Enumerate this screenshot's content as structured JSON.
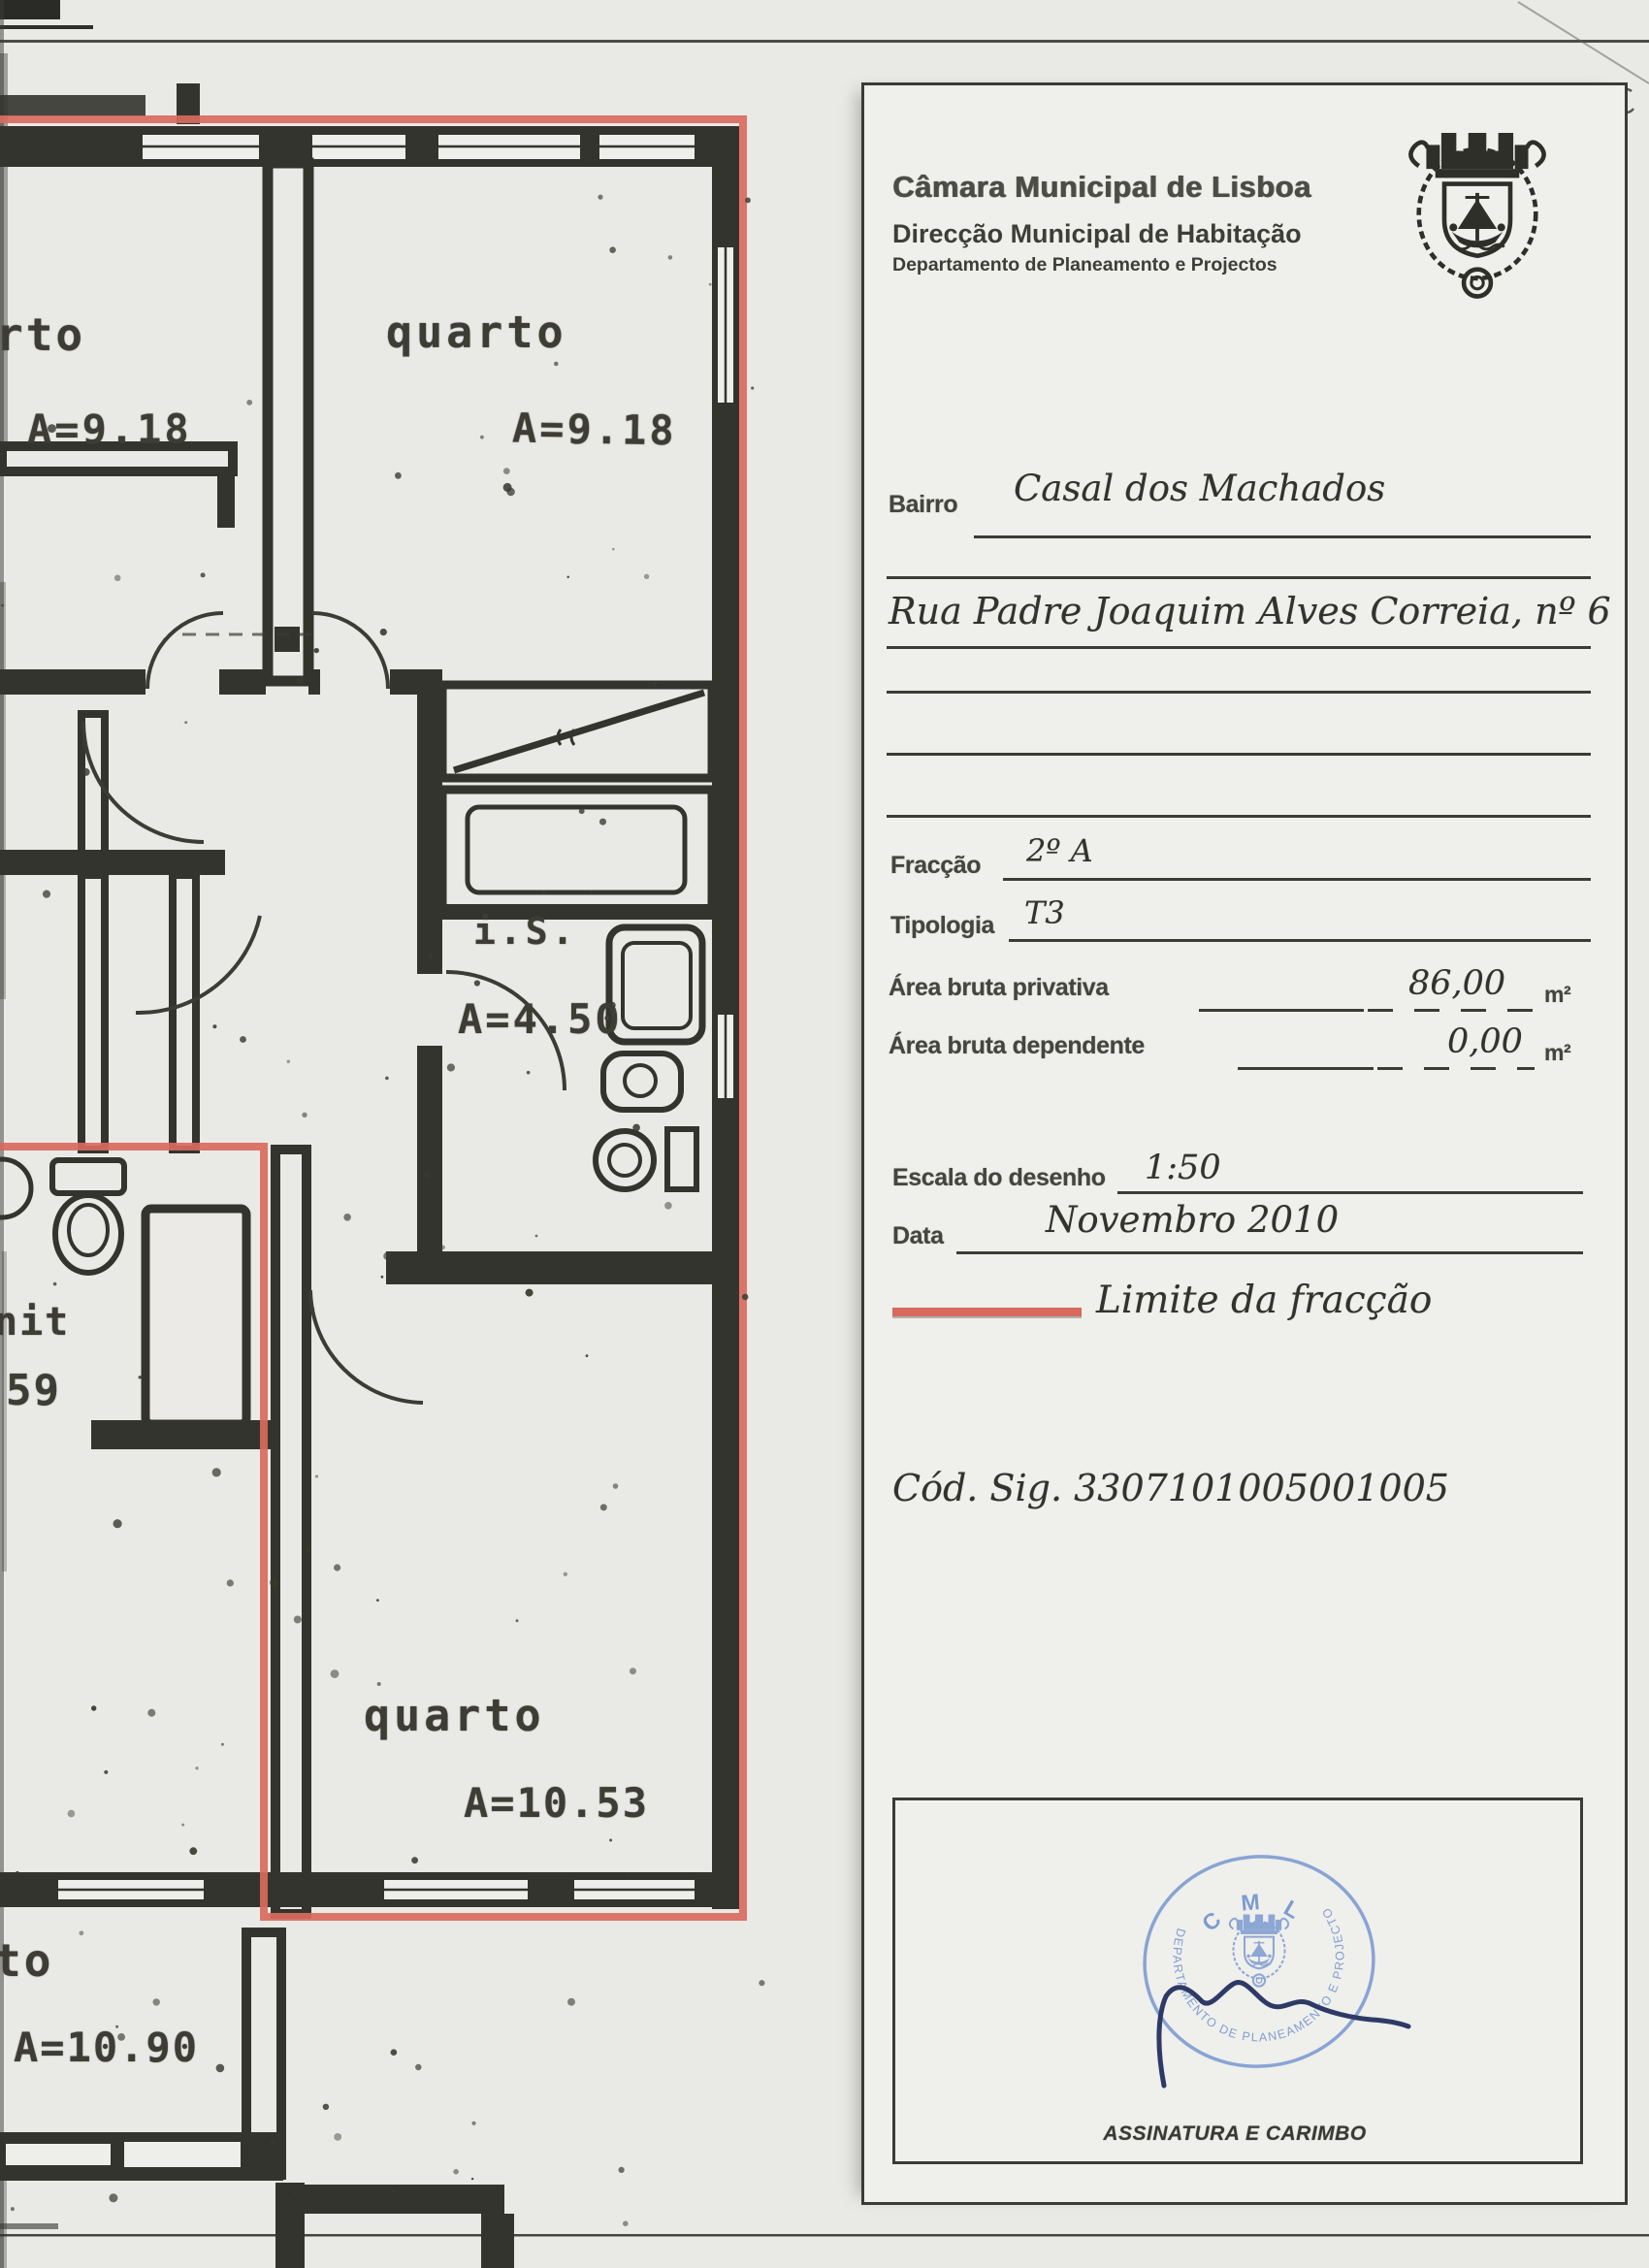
{
  "header": {
    "org": "Câmara Municipal de Lisboa",
    "direction": "Direcção Municipal de Habitação",
    "department": "Departamento de Planeamento e Projectos"
  },
  "form": {
    "bairro_label": "Bairro",
    "bairro_value": "Casal dos Machados",
    "address_value": "Rua Padre Joaquim Alves Correia, nº 6",
    "fraccao_label": "Fracção",
    "fraccao_value": "2º A",
    "tipologia_label": "Tipologia",
    "tipologia_value": "T3",
    "area_privativa_label": "Área bruta privativa",
    "area_privativa_value": "86,00",
    "area_dependente_label": "Área bruta dependente",
    "area_dependente_value": "0,00",
    "area_unit": "m²",
    "escala_label": "Escala do desenho",
    "escala_value": "1:50",
    "data_label": "Data",
    "data_value": "Novembro 2010",
    "legend_label": "Limite da fracção",
    "cod_sig": "Cód. Sig. 3307101005001005",
    "signature_label": "ASSINATURA E CARIMBO"
  },
  "stamp": {
    "top_text": "C M L",
    "ring_text": "DEPARTAMENTO DE PLANEAMENTO E PROJECTOS"
  },
  "plan": {
    "labels": [
      {
        "text": "rto"
      },
      {
        "text": "A=9.18"
      },
      {
        "text": "quarto"
      },
      {
        "text": "A=9.18"
      },
      {
        "text": "i.S."
      },
      {
        "text": "A=4.50"
      },
      {
        "text": "nit"
      },
      {
        "text": "59"
      },
      {
        "text": "quarto"
      },
      {
        "text": "A=10.53"
      },
      {
        "text": "to"
      },
      {
        "text": "A=10.90"
      }
    ]
  },
  "colors": {
    "fraction_line": "#d9695e",
    "stamp_blue": "#7c9bd0",
    "signature_ink": "#2e3a66",
    "wall_ink": "#34342e",
    "paper": "#e9e9e6"
  }
}
